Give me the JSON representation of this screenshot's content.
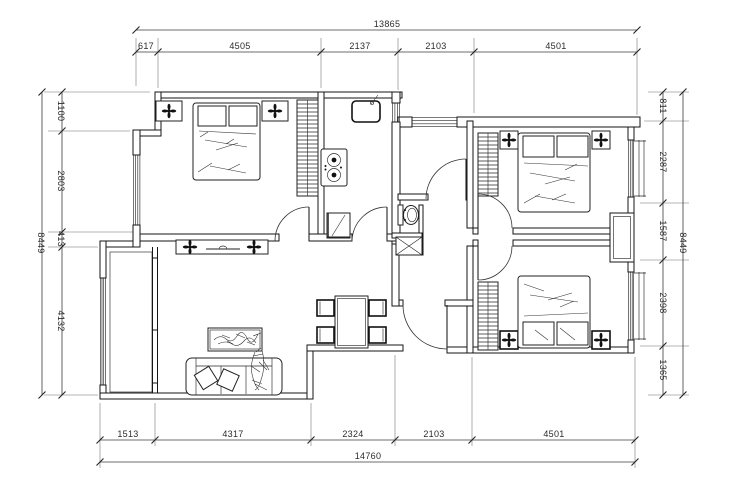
{
  "drawing": {
    "kind": "apartment floor plan (CAD line drawing)",
    "background": "#ffffff",
    "line_color": "#141414",
    "dim_color": "#3c3c3c"
  },
  "dims": {
    "top": {
      "total": "13865",
      "segs": [
        "617",
        "4505",
        "2137",
        "2103",
        "4501"
      ]
    },
    "bottom": {
      "total": "14760",
      "segs": [
        "1513",
        "4317",
        "2324",
        "2103",
        "4501"
      ]
    },
    "left": {
      "total": "8449",
      "segs": [
        "1100",
        "2803",
        "413",
        "4132"
      ]
    },
    "right": {
      "total": "8449",
      "segs": [
        "811",
        "2287",
        "1587",
        "2398",
        "1365"
      ]
    }
  },
  "fixtures": [
    "double-bed",
    "pillow",
    "nightstand-lamp",
    "wardrobe",
    "kitchen-sink",
    "gas-stove",
    "fridge",
    "toilet",
    "vent-shaft",
    "dining-table",
    "dining-chair",
    "sofa",
    "sofa-pillow",
    "plant",
    "coffee-table",
    "tv-cabinet",
    "balcony",
    "window",
    "door-swing",
    "entry-door",
    "ac-bay"
  ]
}
